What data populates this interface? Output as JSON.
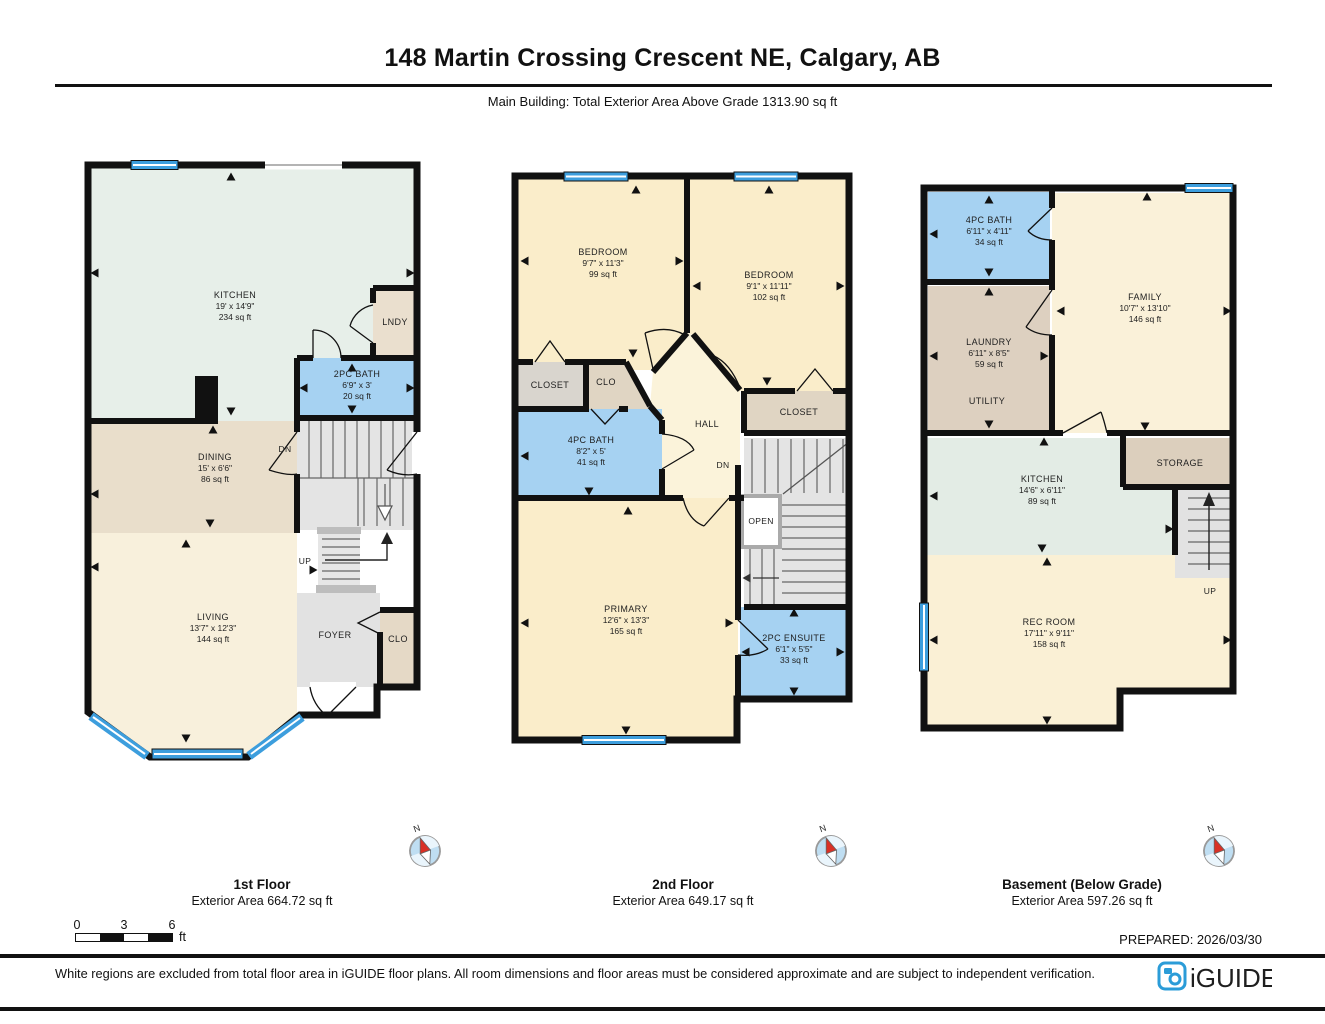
{
  "header": {
    "title": "148 Martin Crossing Crescent NE, Calgary, AB",
    "subtitle": "Main Building: Total Exterior Area Above Grade 1313.90 sq ft"
  },
  "floors": [
    {
      "label": "1st Floor",
      "area_label": "Exterior Area 664.72 sq ft",
      "rooms": {
        "kitchen": {
          "name": "KITCHEN",
          "dims": "19' x 14'9\"",
          "area": "234 sq ft"
        },
        "lndy": {
          "name": "LNDY"
        },
        "bath": {
          "name": "2PC BATH",
          "dims": "6'9\" x 3'",
          "area": "20 sq ft"
        },
        "dining": {
          "name": "DINING",
          "dims": "15' x 6'6\"",
          "area": "86 sq ft"
        },
        "living": {
          "name": "LIVING",
          "dims": "13'7\" x 12'3\"",
          "area": "144 sq ft"
        },
        "foyer": {
          "name": "FOYER"
        },
        "clo": {
          "name": "CLO"
        }
      },
      "stairs": {
        "up": "UP",
        "dn": "DN"
      }
    },
    {
      "label": "2nd Floor",
      "area_label": "Exterior Area 649.17 sq ft",
      "rooms": {
        "bedroom1": {
          "name": "BEDROOM",
          "dims": "9'7\" x 11'3\"",
          "area": "99 sq ft"
        },
        "bedroom2": {
          "name": "BEDROOM",
          "dims": "9'1\" x 11'11\"",
          "area": "102 sq ft"
        },
        "closet_left": {
          "name": "CLOSET"
        },
        "clo": {
          "name": "CLO"
        },
        "hall": {
          "name": "HALL"
        },
        "bath": {
          "name": "4PC BATH",
          "dims": "8'2\" x 5'",
          "area": "41 sq ft"
        },
        "closet_right": {
          "name": "CLOSET"
        },
        "primary": {
          "name": "PRIMARY",
          "dims": "12'6\" x 13'3\"",
          "area": "165 sq ft"
        },
        "ensuite": {
          "name": "2PC ENSUITE",
          "dims": "6'1\" x 5'5\"",
          "area": "33 sq ft"
        }
      },
      "stairs": {
        "dn": "DN",
        "open": "OPEN"
      }
    },
    {
      "label": "Basement (Below Grade)",
      "area_label": "Exterior Area 597.26 sq ft",
      "rooms": {
        "bath": {
          "name": "4PC BATH",
          "dims": "6'11\" x 4'11\"",
          "area": "34 sq ft"
        },
        "laundry": {
          "name": "LAUNDRY",
          "dims": "6'11\" x 8'5\"",
          "area": "59 sq ft"
        },
        "utility": {
          "name": "UTILITY"
        },
        "family": {
          "name": "FAMILY",
          "dims": "10'7\" x 13'10\"",
          "area": "146 sq ft"
        },
        "kitchen": {
          "name": "KITCHEN",
          "dims": "14'6\" x 6'11\"",
          "area": "89 sq ft"
        },
        "storage": {
          "name": "STORAGE"
        },
        "rec": {
          "name": "REC ROOM",
          "dims": "17'11\" x 9'11\"",
          "area": "158 sq ft"
        }
      },
      "stairs": {
        "up": "UP"
      }
    }
  ],
  "compass": {
    "north_label": "N"
  },
  "scale_bar": {
    "ticks": [
      "0",
      "3",
      "6"
    ],
    "unit": "ft"
  },
  "footer": {
    "prepared": "PREPARED: 2026/03/30",
    "disclaimer": "White regions are excluded from total floor area in iGUIDE floor plans. All room dimensions and floor areas must be considered approximate and are subject to independent verification.",
    "brand": "iGUIDE"
  },
  "colors": {
    "wall": "#111111",
    "bath_blue": "#a6d2f2",
    "window_blue": "#3d9edd",
    "cream": "#faedca",
    "mint": "#e7efe9",
    "tan": "#e9decb",
    "gray": "#e4e4e4",
    "brand_blue": "#2b9cd8"
  }
}
